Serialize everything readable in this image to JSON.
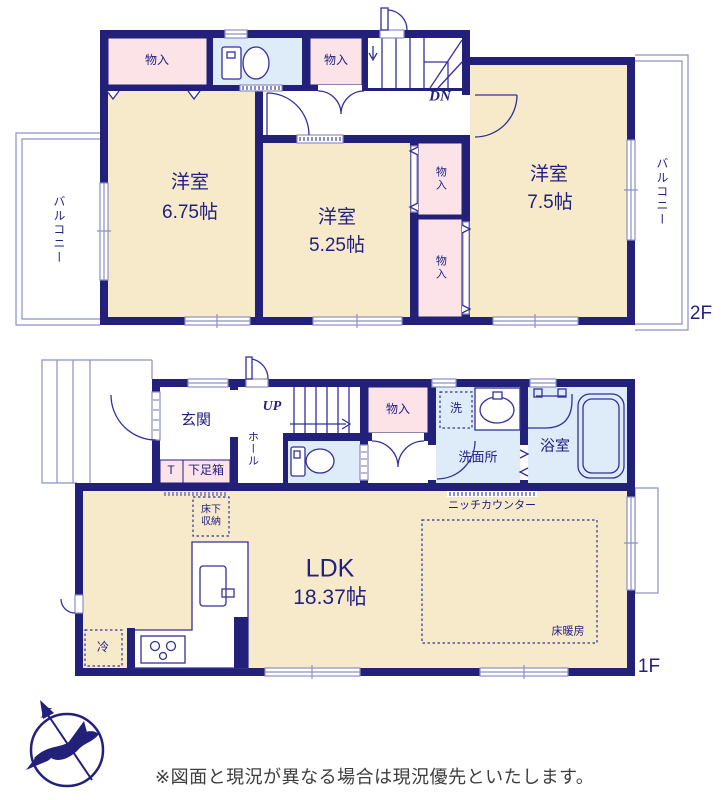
{
  "floor2": {
    "floor_label": "2F",
    "balcony_left": "バルコニー",
    "balcony_right": "バルコニー",
    "storage_top_left": "物入",
    "storage_top_mid": "物入",
    "storage_mid_upper": "物入",
    "storage_mid_lower": "物入",
    "stairs_down": "DN",
    "room_a_name": "洋室",
    "room_a_size": "6.75帖",
    "room_b_name": "洋室",
    "room_b_size": "5.25帖",
    "room_c_name": "洋室",
    "room_c_size": "7.5帖"
  },
  "floor1": {
    "floor_label": "1F",
    "entrance": "玄関",
    "hall": "ホール",
    "stairs_up": "UP",
    "toilet_t": "T",
    "shoe_box": "下足箱",
    "underfloor_storage": "床下\n収納",
    "storage": "物入",
    "washer": "洗",
    "washroom": "洗面所",
    "bathroom": "浴室",
    "niche_counter": "ニッチカウンター",
    "ldk_name": "LDK",
    "ldk_size": "18.37帖",
    "floor_heating": "床暖房",
    "refrigerator": "冷"
  },
  "compass": {
    "north": "N"
  },
  "footer": {
    "disclaimer": "※図面と現況が異なる場合は現況優先といたします。"
  },
  "colors": {
    "wall": "#23207a",
    "room_cream": "#f7eacb",
    "closet_pink": "#fbe3e8",
    "wet_blue": "#ddecf8",
    "line": "#34309b",
    "window_line": "#8d90c7",
    "text_navy": "#232082",
    "footer_text": "#3d3d3d"
  }
}
